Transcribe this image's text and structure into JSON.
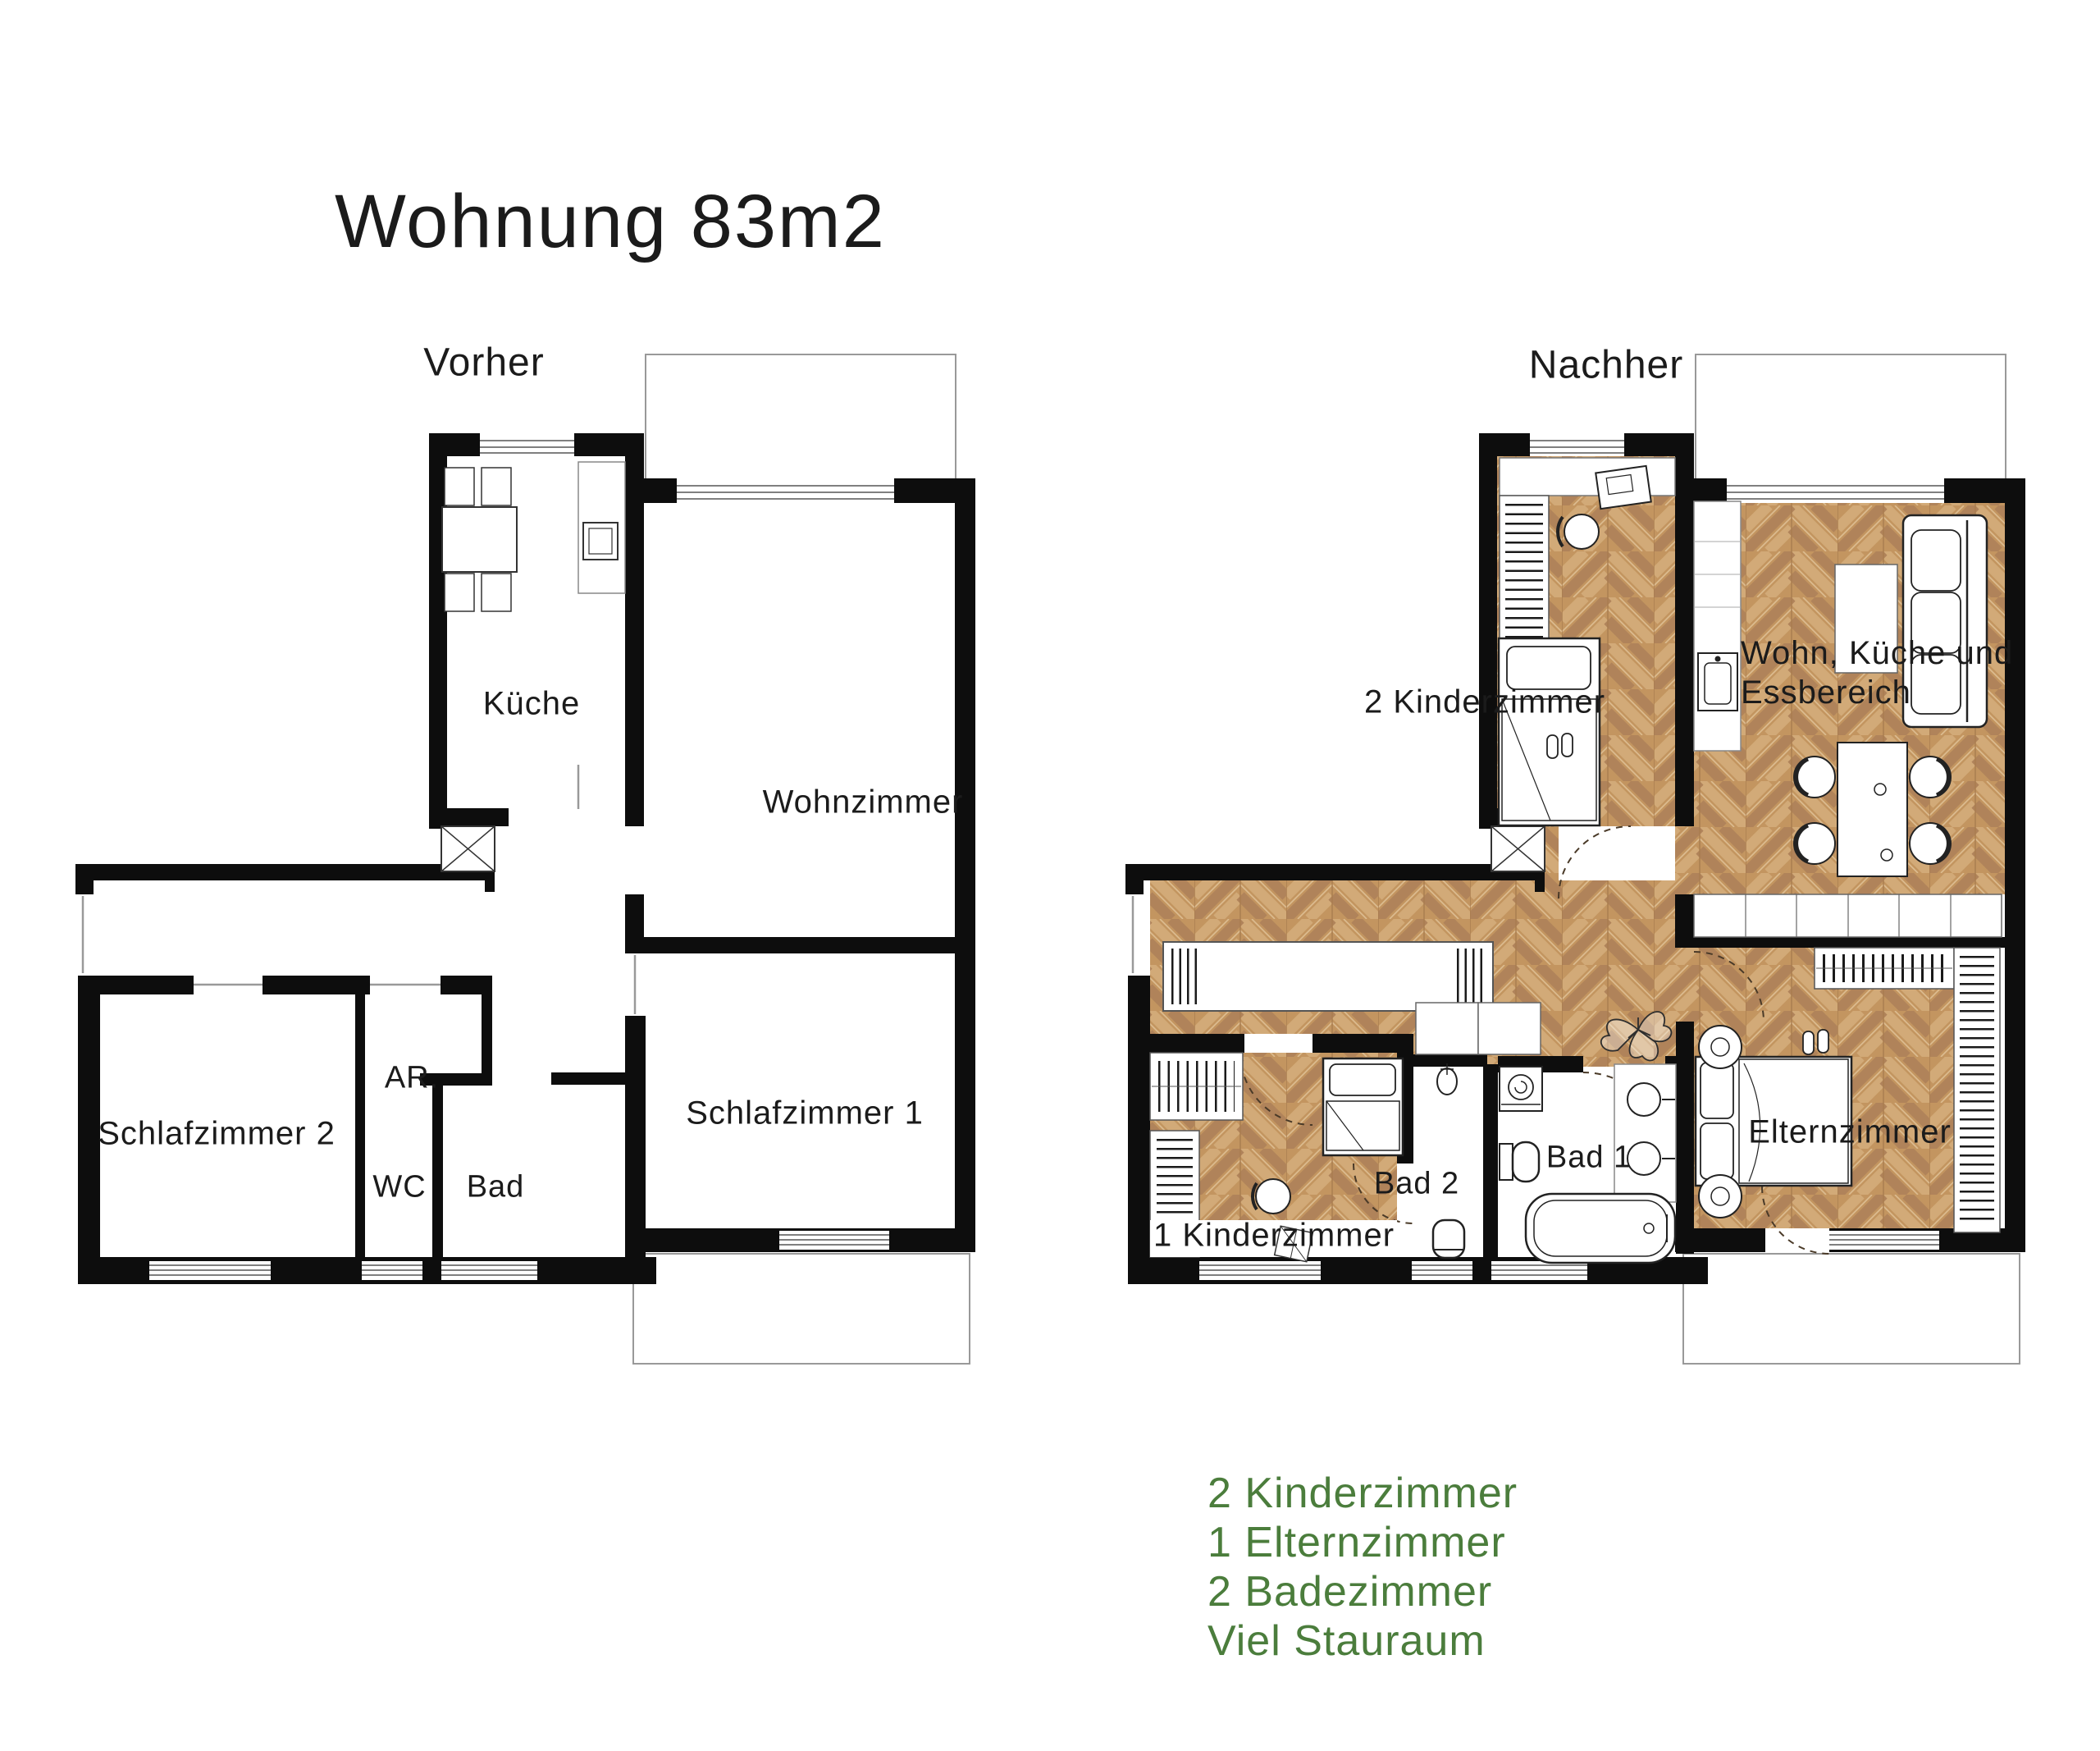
{
  "title": "Wohnung 83m2",
  "before_plan": {
    "label": "Vorher",
    "rooms": {
      "kueche": "Küche",
      "wohnzimmer": "Wohnzimmer",
      "schlafzimmer2": "Schlafzimmer 2",
      "abstellraum": "AR.",
      "wc": "WC",
      "bad": "Bad",
      "schlafzimmer1": "Schlafzimmer 1"
    }
  },
  "after_plan": {
    "label": "Nachher",
    "rooms": {
      "kinderzimmer2": "2 Kinderzimmer",
      "wohnbereich_line1": "Wohn, Küche und",
      "wohnbereich_line2": "Essbereich",
      "kinderzimmer1": "1 Kinderzimmer",
      "bad2": "Bad 2",
      "bad1": "Bad 1",
      "elternzimmer": "Elternzimmer"
    }
  },
  "features": {
    "items": [
      "2 Kinderzimmer",
      "1 Elternzimmer",
      "2 Badezimmer",
      "Viel Stauraum"
    ]
  },
  "colors": {
    "feature_text": "#4b7d3c",
    "wall": "#0d0d0d",
    "wood_light": "#d2aa78",
    "wood_mid": "#c39560",
    "wood_dark": "#b0835a"
  }
}
